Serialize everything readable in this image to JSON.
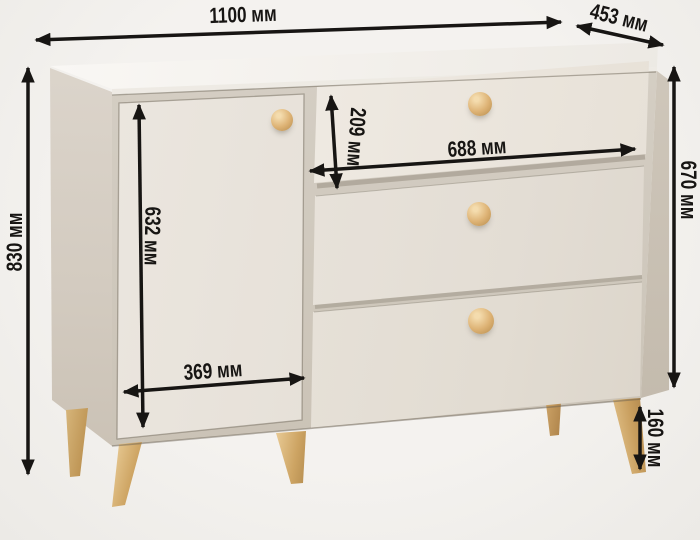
{
  "diagram": {
    "subject": "chest of drawers (one door, three drawers) with dimension callouts",
    "unit": "мм",
    "dimensions": {
      "width": "1100 мм",
      "depth": "453 мм",
      "height": "830 мм",
      "body_height": "670 мм",
      "top_drawer_height": "209 мм",
      "drawer_width": "688 мм",
      "door_height": "632 мм",
      "door_width": "369 мм",
      "leg_height": "160 мм"
    },
    "colors": {
      "background": "#f1efec",
      "annotation": "#171513",
      "cabinet_front": "#e9e4dc",
      "cabinet_side": "#d3cbc0",
      "cabinet_top": "#f4f1ec",
      "wood_accent": "#d5ab6c"
    }
  }
}
